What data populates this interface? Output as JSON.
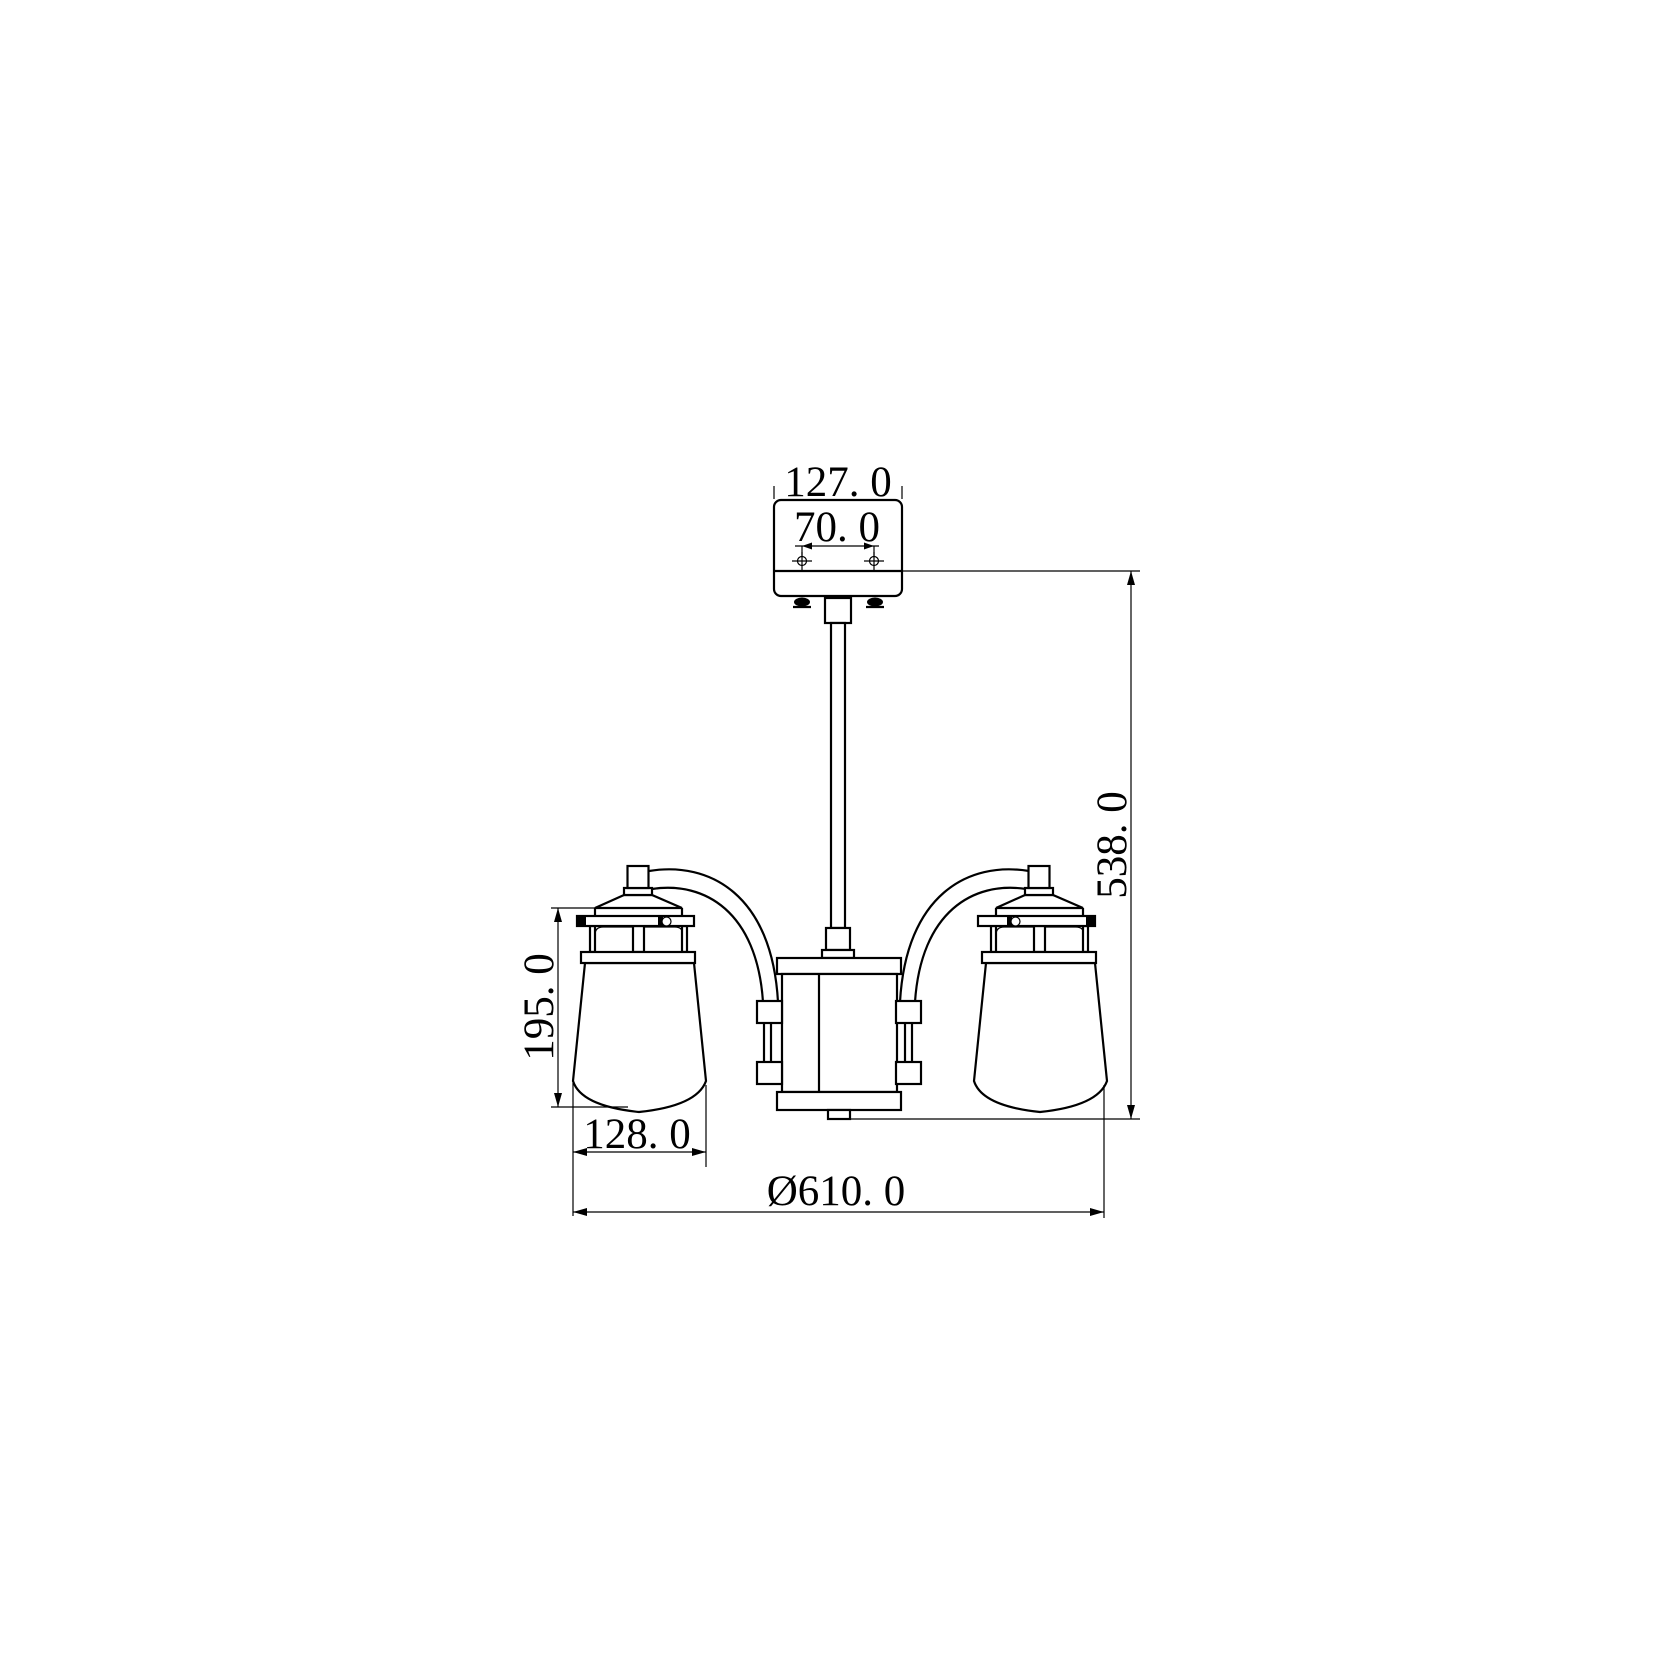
{
  "drawing": {
    "labels": {
      "canopy_width": "127. 0",
      "hole_spacing": "70. 0",
      "overall_height": "538. 0",
      "shade_height": "195. 0",
      "shade_width": "128. 0",
      "overall_diameter": "Ø610. 0"
    },
    "colors": {
      "line": "#000000",
      "background": "#ffffff"
    }
  }
}
